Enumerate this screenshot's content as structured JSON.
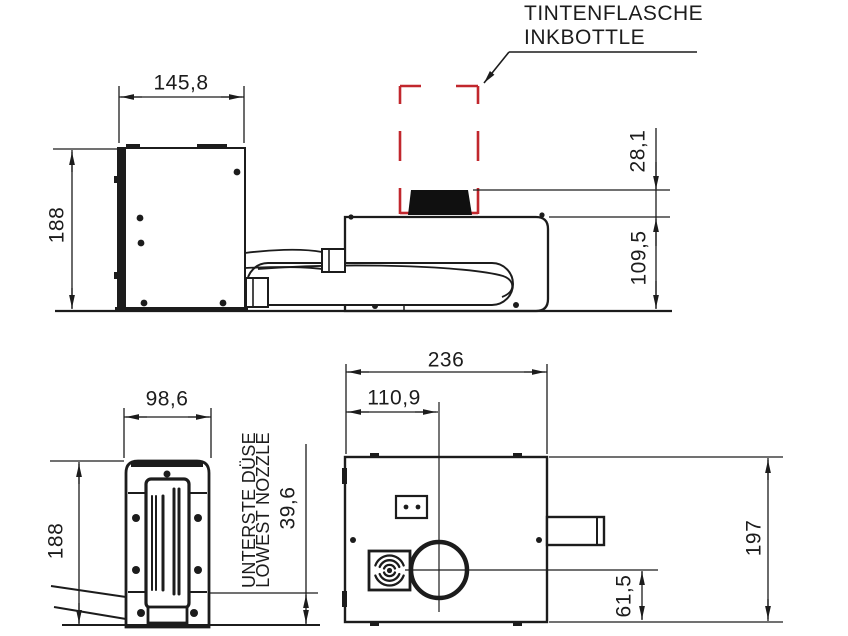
{
  "drawing": {
    "annotation": {
      "line1": "TINTENFLASCHE",
      "line2": "INKBOTTLE"
    },
    "head_side_view": {
      "width_mm": "145,8",
      "height_mm": "188"
    },
    "controller_side_view": {
      "bottle_clearance_mm": "28,1",
      "body_height_mm": "109,5"
    },
    "head_front_view": {
      "width_mm": "98,6",
      "height_mm": "188",
      "nozzle_label_de": "UNTERSTE DÜSE",
      "nozzle_label_en": "LOWEST NOZZLE",
      "lowest_nozzle_mm": "39,6"
    },
    "controller_top_view": {
      "width_mm": "236",
      "bottle_center_offset_mm": "110,9",
      "depth_mm": "197",
      "bottle_center_from_front_mm": "61,5"
    },
    "colors": {
      "line": "#1c1c1c",
      "highlight": "#c1272d",
      "background": "#ffffff"
    }
  }
}
